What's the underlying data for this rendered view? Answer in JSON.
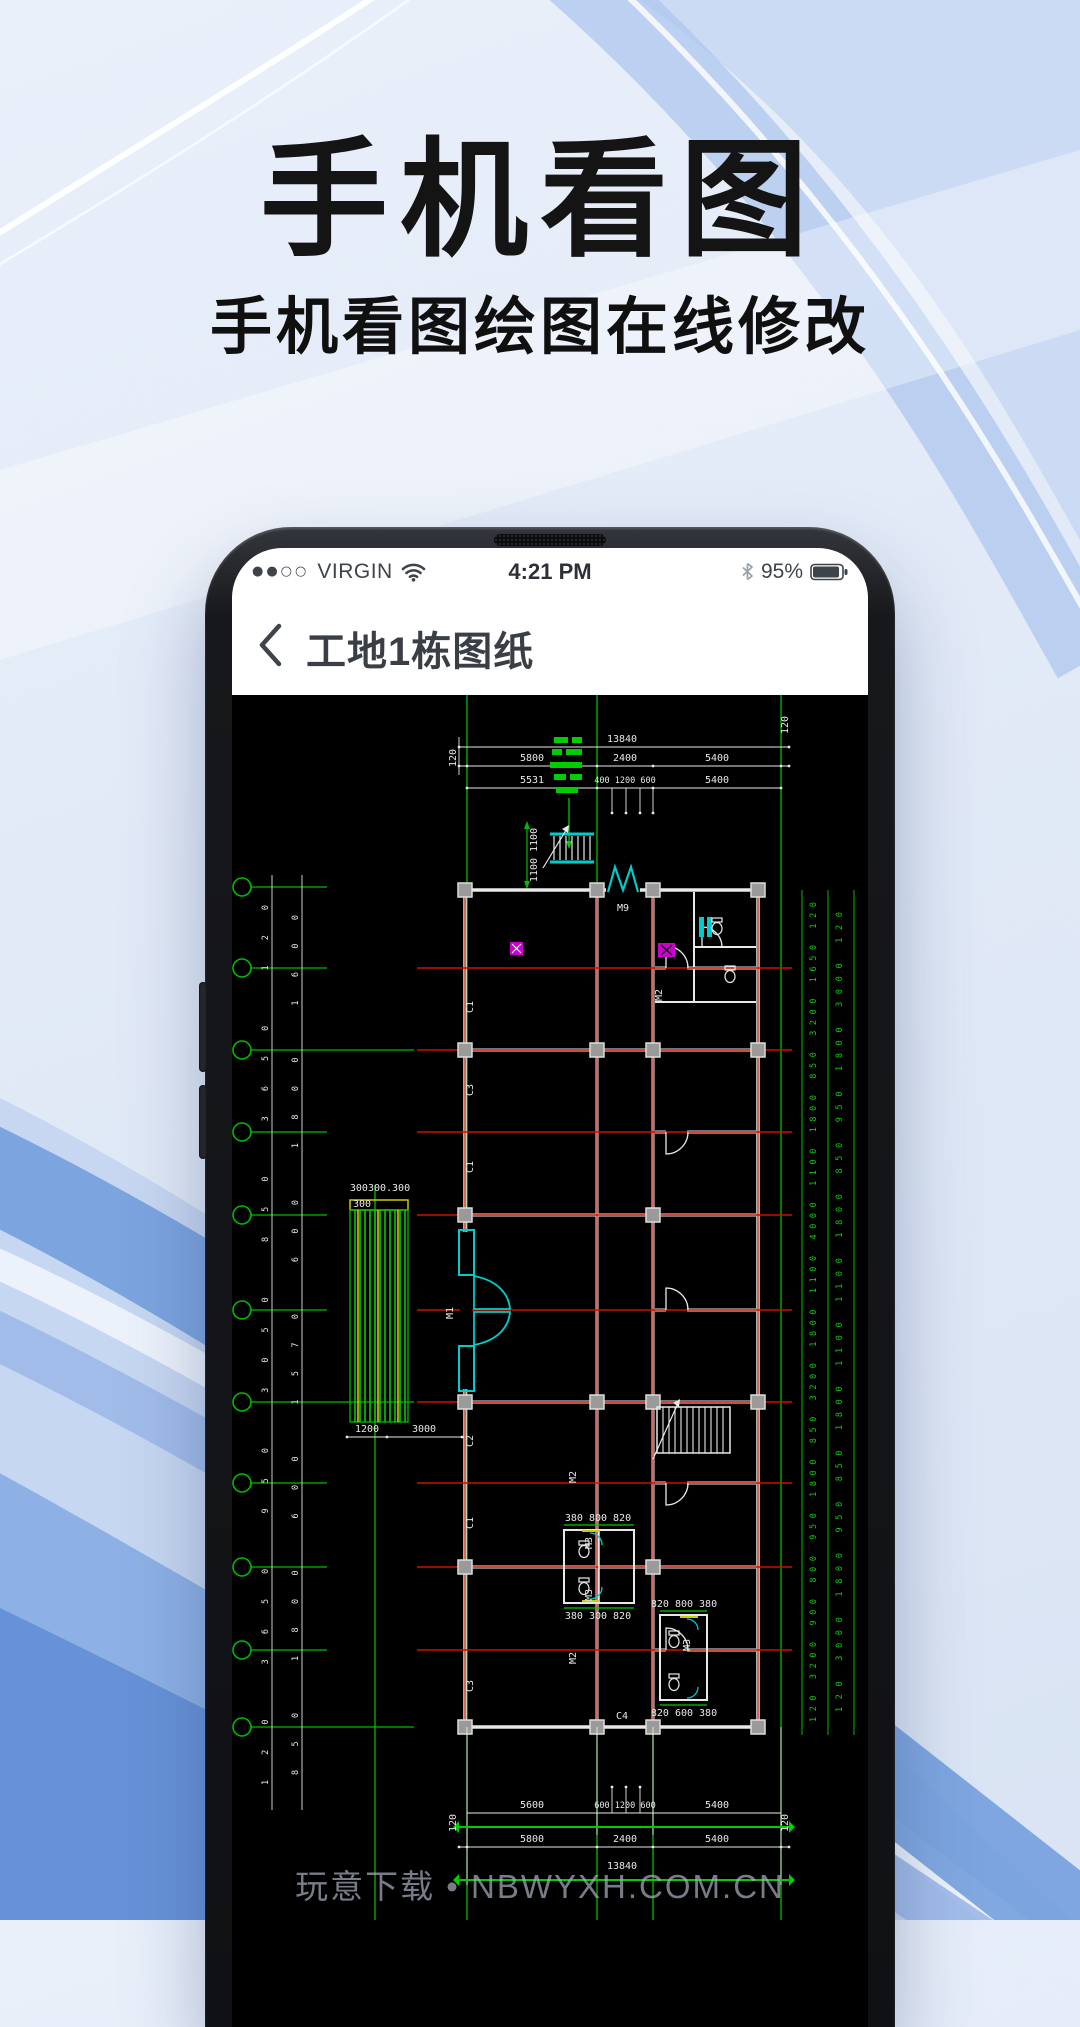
{
  "hero": {
    "title": "手机看图",
    "subtitle": "手机看图绘图在线修改"
  },
  "watermark": "玩意下载 • NBWYXH.COM.CN",
  "phone": {
    "status": {
      "signal_dots": "●●○○",
      "carrier": "VIRGIN",
      "time": "4:21 PM",
      "battery_pct": "95%"
    },
    "nav": {
      "title": "工地1栋图纸"
    }
  },
  "cad": {
    "palette": {
      "grid_green": "#00bb00",
      "dim_white": "#e8e8e8",
      "axis_red": "#cc1100",
      "door_cyan": "#00cccc",
      "accent_magenta": "#cc00cc",
      "hatch_yellow": "#cccc00",
      "column_gray": "#999999"
    },
    "dims_top": {
      "total": "13840",
      "seg_120_l": "120",
      "seg_5800": "5800",
      "seg_2400": "2400",
      "seg_5400": "5400",
      "seg_120_r": "120",
      "row3_left": "5531",
      "row3_mid": "400 1200 600",
      "row3_right": "5400"
    },
    "dims_bottom": {
      "row1_left": "5600",
      "row1_mid": "600 1200 600",
      "row1_right": "5400",
      "seg_120_l": "120",
      "seg_5800": "5800",
      "seg_2400": "2400",
      "seg_5400": "5400",
      "seg_120_r": "120",
      "total": "13840"
    },
    "dims_left_col1": "120  3650  950  3050  850  3650  120",
    "dims_left_col2": "850  1800  600  1570  600  1800  1600",
    "dims_right_col1": "120 3200 900 800 950 1800 850 3200 1800 1100 4000 1100 1800 850 3200 1650 120",
    "dims_right_col2": "120 3000 1800 950 850 1800 1100 1100 1800 850 950 1800 3000 120",
    "dims_stair": "1100 1100",
    "dims_porch_top": "300300.300",
    "dims_porch_300": "300",
    "dims_porch_1200": "1200",
    "dims_porch_3000": "3000",
    "dims_bath_top": "380  800 820",
    "dims_bath_bottom": "380  300 820",
    "dims_bath_right_top": "820 800  380",
    "dims_bath_right_bottom": "820 600  380",
    "labels": {
      "door_m1": "M1",
      "door_m2": "M2",
      "door_m3": "M3",
      "door_m9": "M9",
      "win_c1": "C1",
      "win_c2": "C2",
      "win_c3": "C3",
      "win_c4": "C4"
    }
  }
}
